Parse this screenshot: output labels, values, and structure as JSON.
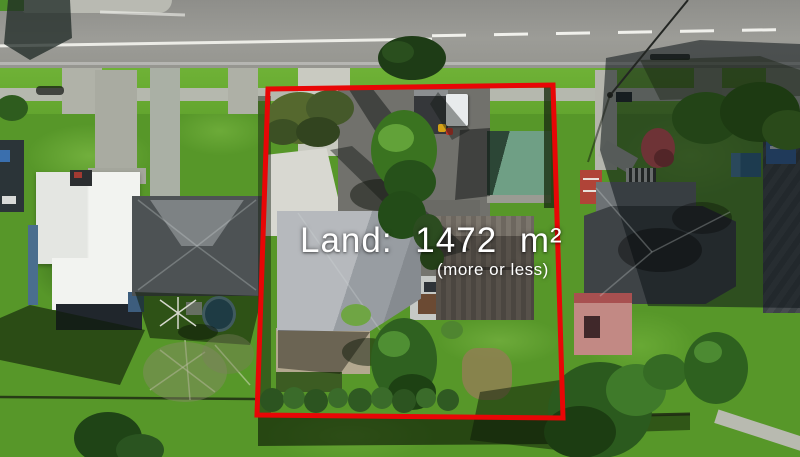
{
  "annotation": {
    "land_label": "Land: 1472 m²",
    "land_qualifier": "(more or less)",
    "text_color": "#ffffff",
    "boundary_color": "#e80606"
  },
  "scene": {
    "palette": {
      "road_gray": "#97978f",
      "lane_marking_white": "#f5f5f0",
      "grass_green": "#579729",
      "grass_bright": "#74b13a",
      "shadow_green": "#14260a",
      "footpath_gray": "#b5b8ae",
      "concrete_light": "#d8d8d1",
      "roof_white": "#eff0ed",
      "roof_light_gray": "#b6b9bd",
      "roof_dark_gray": "#4d5254",
      "roof_brown_gray": "#4b4640",
      "garage_green": "#6f9f85",
      "patio_tan": "#b3a88f",
      "pool_blue": "#33648f",
      "truck_blue": "#2a62a5",
      "pink_building": "#c28984",
      "red_porch": "#b04438"
    }
  }
}
